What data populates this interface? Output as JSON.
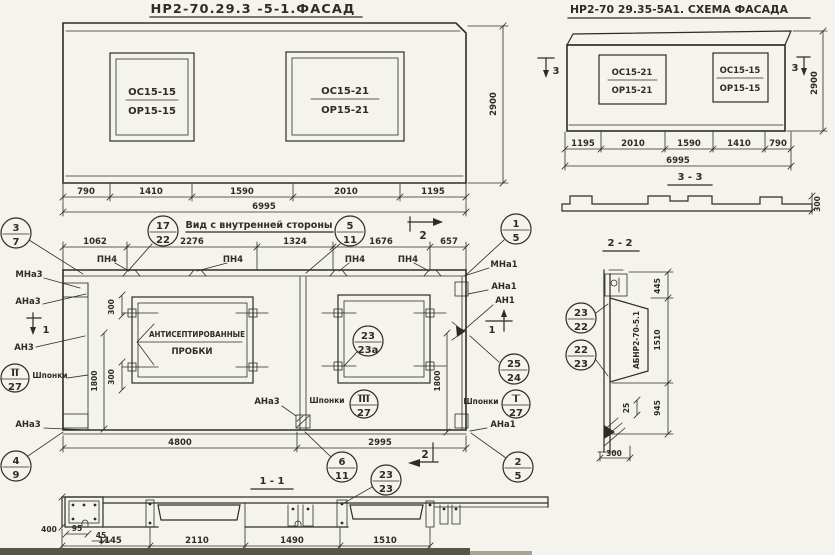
{
  "colors": {
    "ink": "#2e2c26",
    "paper": "#f4f3ee",
    "band": "#57544b",
    "band2": "#a6a399"
  },
  "facade_left": {
    "title": "НР2-70.29.3 -5-1.ФАСАД",
    "window_a": {
      "line1": "ОС15-15",
      "line2": "ОР15-15"
    },
    "window_b": {
      "line1": "ОС15-21",
      "line2": "ОР15-21"
    },
    "dims": [
      "790",
      "1410",
      "1590",
      "2010",
      "1195"
    ],
    "total": "6995",
    "height": "2900"
  },
  "facade_schema": {
    "title": "НР2-70 29.35-5А1. СХЕМА ФАСАДА",
    "window_a": {
      "line1": "ОС15-21",
      "line2": "ОР15-21"
    },
    "window_b": {
      "line1": "ОС15-15",
      "line2": "ОР15-15"
    },
    "dims": [
      "1195",
      "2010",
      "1590",
      "1410",
      "790"
    ],
    "total": "6995",
    "height": "2900",
    "cut_left": "3",
    "cut_right": "3"
  },
  "section_33": {
    "label": "3 - 3",
    "dim": "300"
  },
  "inner_view": {
    "title": "Вид с внутренней стороны",
    "dims_top": [
      "1062",
      "2276",
      "1324",
      "1676",
      "657"
    ],
    "loop_label": "ПН4",
    "cut1": "1",
    "cut2": "2",
    "labels": {
      "mna3": "МНа3",
      "ana3": "АНа3",
      "an3": "АН3",
      "shponki": "Шпонки",
      "mna1": "МНа1",
      "ana1": "АНа1",
      "an1": "АН1"
    },
    "plug_note_1": "АНТИСЕПТИРОВАННЫЕ",
    "plug_note_2": "ПРОБКИ",
    "callouts": {
      "c37": {
        "top": "3",
        "bot": "7"
      },
      "c1722": {
        "top": "17",
        "bot": "22"
      },
      "c511": {
        "top": "5",
        "bot": "11"
      },
      "c15": {
        "top": "1",
        "bot": "5"
      },
      "c2324a": {
        "top": "23",
        "bot": "23а"
      },
      "c2524": {
        "top": "25",
        "bot": "24"
      },
      "c127": {
        "top": "I",
        "bot": "27"
      },
      "c227": {
        "top": "II",
        "bot": "27"
      },
      "c327": {
        "top": "III",
        "bot": "27"
      },
      "c49": {
        "top": "4",
        "bot": "9"
      },
      "c611": {
        "top": "6",
        "bot": "11"
      },
      "c2323": {
        "top": "23",
        "bot": "23"
      },
      "c25": {
        "top": "2",
        "bot": "5"
      }
    },
    "dims": {
      "d300": "300",
      "d1800": "1800",
      "d4800": "4800",
      "d2995": "2995"
    }
  },
  "section_11": {
    "label": "1 - 1",
    "dims": [
      "400",
      "95",
      "45",
      "1145",
      "2110",
      "1490",
      "1510"
    ]
  },
  "section_22": {
    "label": "2 - 2",
    "part": "АБНР2-70-5.1",
    "dims": {
      "d445": "445",
      "d1510": "1510",
      "d945": "945",
      "d25": "25",
      "d300": "300"
    }
  }
}
